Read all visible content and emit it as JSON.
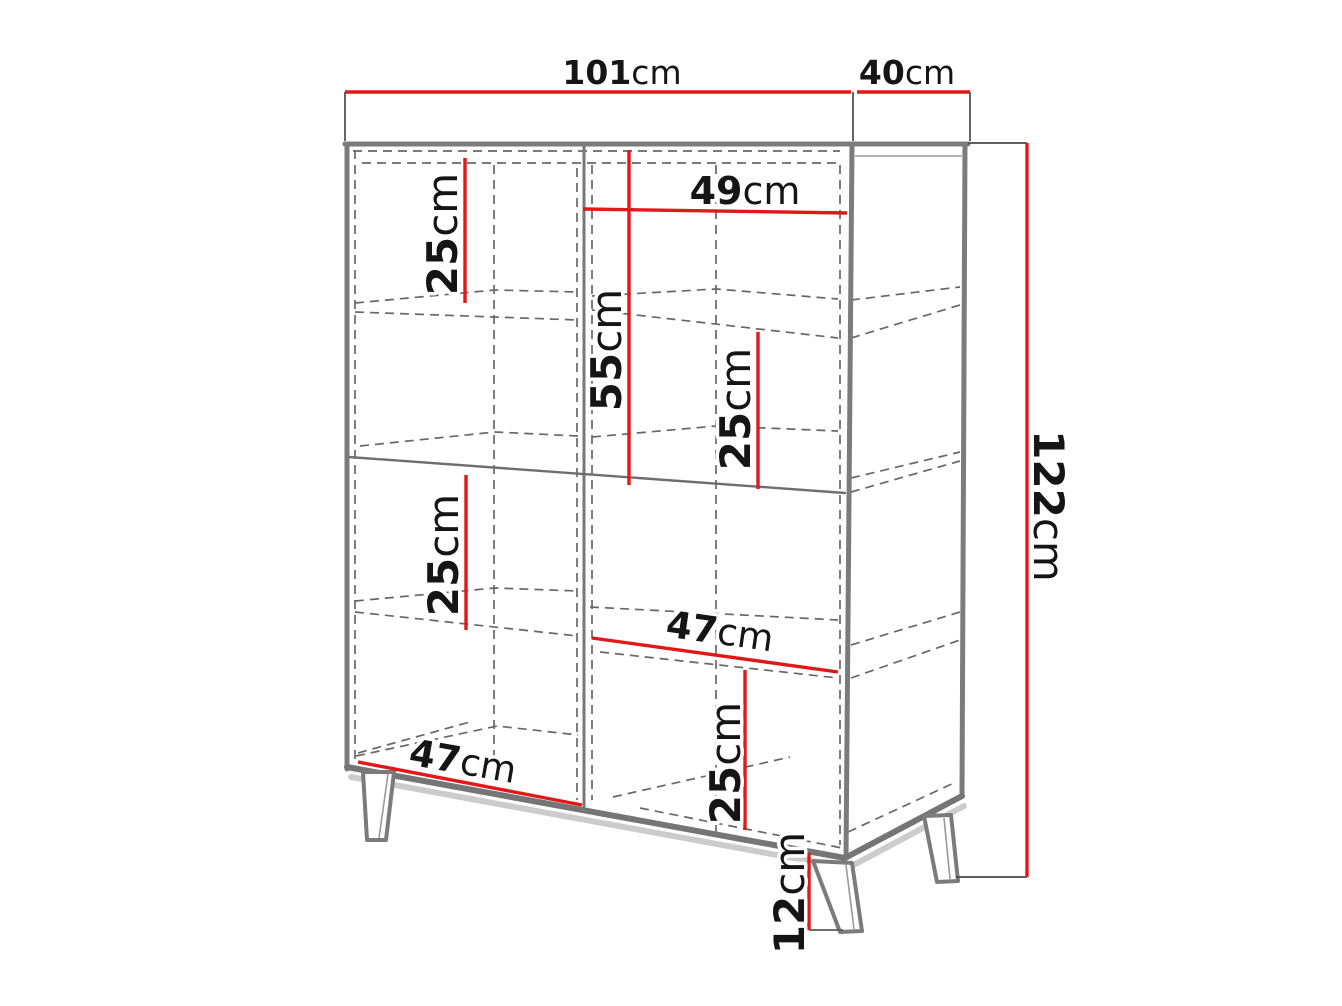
{
  "diagram": {
    "kind": "furniture-dimension-diagram",
    "subject": "two-door display cabinet on splayed legs",
    "unit_system": "cm",
    "colors": {
      "dimension_red": "#e21717",
      "carcass_gray": "#7b7b7b",
      "dashed_gray": "#686868",
      "extension_dark": "#4a4a4a",
      "text_black": "#151515",
      "background": "#ffffff"
    },
    "dimensions": {
      "overall_width": {
        "value": "101",
        "unit": "cm"
      },
      "overall_depth": {
        "value": "40",
        "unit": "cm"
      },
      "overall_height": {
        "value": "122",
        "unit": "cm"
      },
      "top_left_shelf_height": {
        "value": "25",
        "unit": "cm"
      },
      "right_opening_width": {
        "value": "49",
        "unit": "cm"
      },
      "upper_section_height": {
        "value": "55",
        "unit": "cm"
      },
      "upper_right_shelf_height": {
        "value": "25",
        "unit": "cm"
      },
      "lower_left_shelf_height": {
        "value": "25",
        "unit": "cm"
      },
      "lower_right_opening_width": {
        "value": "47",
        "unit": "cm"
      },
      "bottom_left_opening_width": {
        "value": "47",
        "unit": "cm"
      },
      "bottom_right_shelf_height": {
        "value": "25",
        "unit": "cm"
      },
      "leg_height": {
        "value": "12",
        "unit": "cm"
      }
    }
  }
}
